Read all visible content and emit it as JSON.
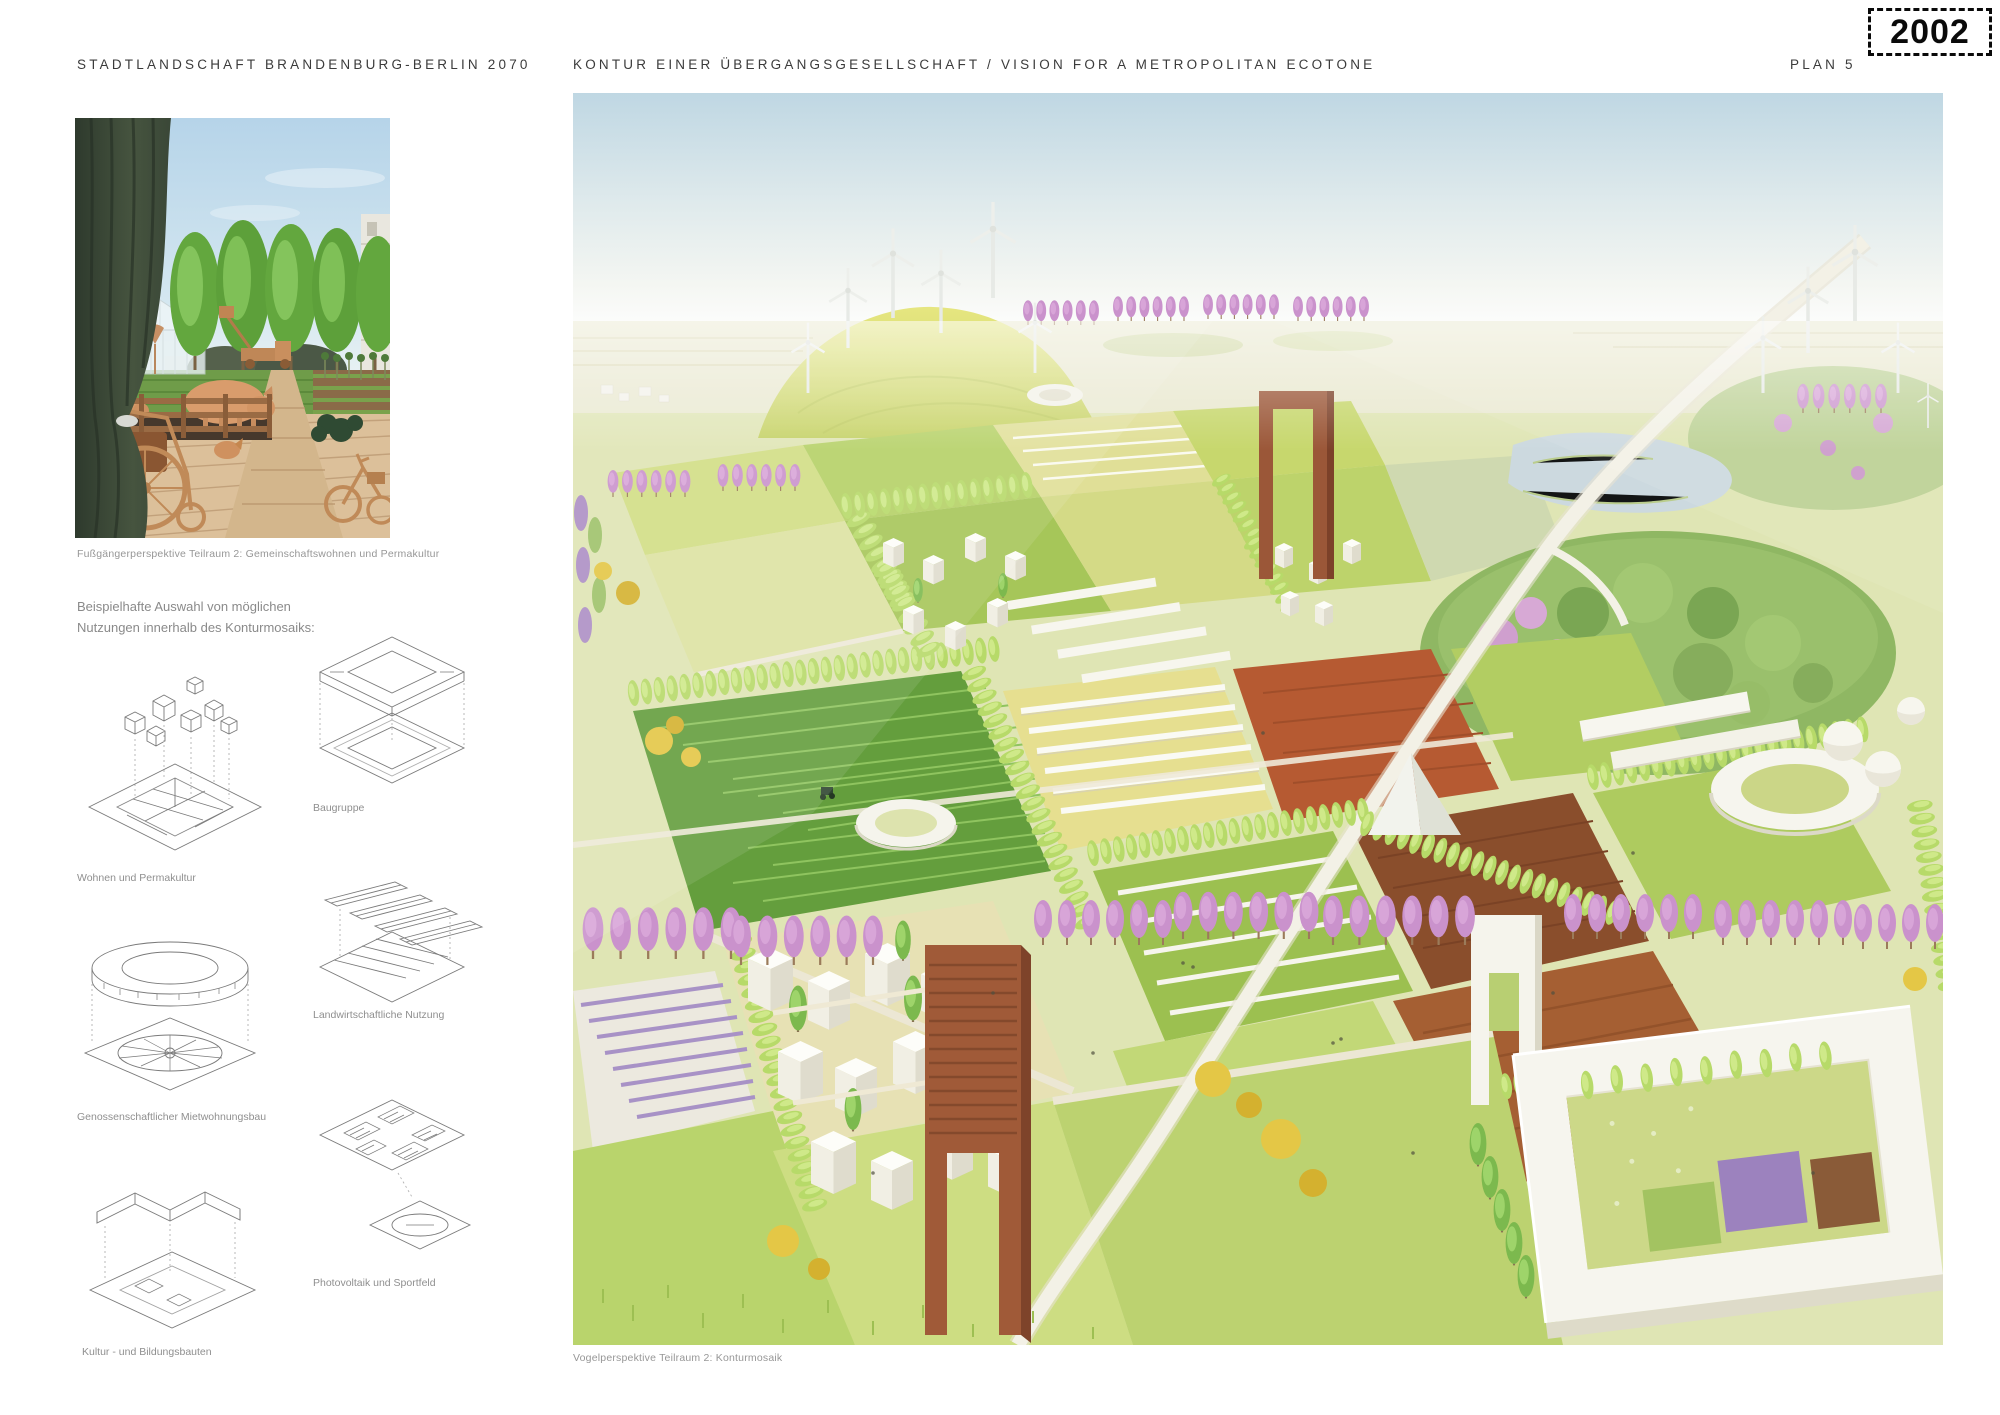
{
  "page": {
    "entry_number": "2002"
  },
  "header": {
    "left_title": "STADTLANDSCHAFT BRANDENBURG-BERLIN 2070",
    "center_title": "KONTUR EINER ÜBERGANGSGESELLSCHAFT / VISION FOR A METROPOLITAN ECOTONE",
    "plan_label": "PLAN 5"
  },
  "left_column": {
    "photo_caption": "Fußgängerperspektive Teilraum 2: Gemeinschaftswohnen und Permakultur",
    "intro_text": "Beispielhafte Auswahl von möglichen Nutzungen innerhalb des Konturmosaiks:",
    "diagrams": [
      {
        "label": "Wohnen und Permakultur"
      },
      {
        "label": "Baugruppe"
      },
      {
        "label": "Genossenschaftlicher Mietwohnungsbau"
      },
      {
        "label": "Landwirtschaftliche Nutzung"
      },
      {
        "label": "Kultur - und Bildungsbauten"
      },
      {
        "label": "Photovoltaik und Sportfeld"
      }
    ]
  },
  "main_image": {
    "caption": "Vogelperspektive Teilraum 2: Konturmosaik"
  },
  "colors": {
    "sky_blue": "#bfd7e3",
    "field_green": "#9ebf4f",
    "field_yellow": "#e0df97",
    "soil_brown": "#8a4e2c",
    "corten_brown": "#9b5738",
    "tree_pink": "#ca92cc",
    "poplar_green": "#b7da69",
    "building_white": "#f6f5ee",
    "curtain_green": "#3d4a3c",
    "copper": "#c98e5f"
  }
}
